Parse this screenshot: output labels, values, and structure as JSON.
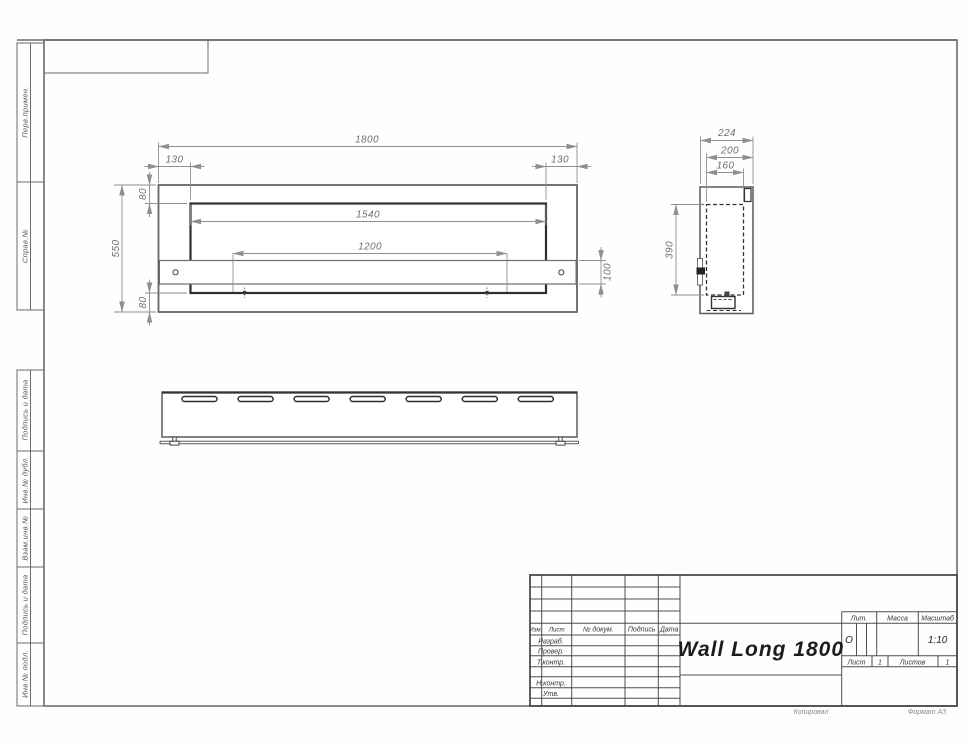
{
  "sheet": {
    "copy_label": "Копировал",
    "format_label": "Формат А3"
  },
  "colors": {
    "outline": "#6c6c6c",
    "thick_line": "#2e2e2e",
    "dim_line": "#8f8f8f",
    "frame": "#6a6a6a",
    "title_ink": "#4d4d4d"
  },
  "margin_labels": {
    "items": [
      {
        "label": "Перв.примен."
      },
      {
        "label": "Справ.№"
      },
      {
        "label": "Подпись и дата"
      },
      {
        "label": "Инв.№ дубл."
      },
      {
        "label": "Взам.инв.№"
      },
      {
        "label": "Подпись и дата"
      },
      {
        "label": "Инв.№ подл."
      }
    ]
  },
  "views": {
    "front": {
      "dims": {
        "total_width": "1800",
        "left_offset": "130",
        "right_offset": "130",
        "top_offset": "80",
        "opening_width": "1540",
        "bracket_span": "1200",
        "total_height": "550",
        "bracket_height": "100",
        "bottom_offset": "80"
      }
    },
    "side": {
      "dims": {
        "total_depth": "224",
        "body_depth": "200",
        "inner_depth": "160",
        "inner_height": "390"
      }
    }
  },
  "title_block": {
    "doc_name": "Wall Long 1800",
    "header_cols": [
      {
        "label": "Изм."
      },
      {
        "label": "Лист"
      },
      {
        "label": "№ докум."
      },
      {
        "label": "Подпись"
      },
      {
        "label": "Дата"
      }
    ],
    "sign_rows": [
      {
        "label": "Разраб."
      },
      {
        "label": "Провер."
      },
      {
        "label": "Т.контр."
      },
      {
        "label": "Н.контр."
      },
      {
        "label": "Утв."
      }
    ],
    "lit": {
      "label": "Лит.",
      "value": "О"
    },
    "mass": {
      "label": "Масса",
      "value": ""
    },
    "scale": {
      "label": "Масштаб",
      "value": "1:10"
    },
    "sheet_no": {
      "label": "Лист",
      "value": "1"
    },
    "sheets_total": {
      "label": "Листов",
      "value": "1"
    }
  }
}
